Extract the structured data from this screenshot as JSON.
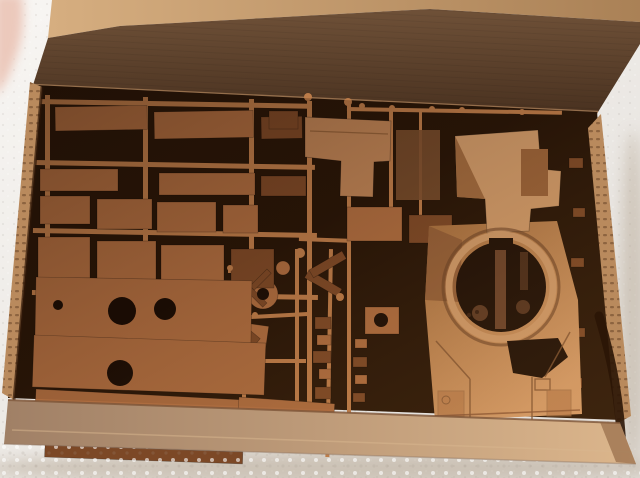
{
  "scene": {
    "image_type": "photograph",
    "subject": "Opened cardboard model-kit box filled with tan plastic sprue frames of tank parts and a one-piece tank upper hull with a circular turret ring, resting on white styrofoam; a fingertip intrudes at the top-left corner",
    "colors": {
      "foam_light": "#f8f6f3",
      "foam_shade": "#e3dfda",
      "finger": "#ecc9bc",
      "lid_edge_light": "#d6ae80",
      "lid_edge_dark": "#aa8156",
      "lid_top": "#6f5138",
      "lid_bottom": "#4a3220",
      "fold_highlight": "#9c7450",
      "interior": "#271507",
      "cardboard": "#b98a5d",
      "cardboard_dark": "#8a5f3c",
      "wall_dark": "#a08066",
      "wall_light": "#dcb68c",
      "sprue": "#ad6c3f",
      "sprue_light": "#cf9257",
      "sprue_dark": "#7c4826",
      "sprue_runner": "#bd7c49",
      "hole_dark": "#190c04",
      "hull_grad_top": "#a9713f",
      "hull_grad_bottom": "#d29a67",
      "hull_light": "#cf9a69",
      "hull_mid": "#b5794a",
      "hull_dark": "#7e5231",
      "shadow_tint": "#b7a996"
    },
    "sprue": {
      "runners_h": [
        [
          37,
          99,
          273,
          5,
          1
        ],
        [
          35,
          160,
          280,
          5,
          1
        ],
        [
          33,
          228,
          284,
          5,
          1
        ],
        [
          32,
          290,
          286,
          5,
          1
        ],
        [
          347,
          107,
          215,
          4,
          1
        ],
        [
          251,
          315,
          59,
          4,
          -3
        ],
        [
          299,
          237,
          49,
          4,
          2
        ],
        [
          249,
          359,
          57,
          4,
          0
        ],
        [
          298,
          429,
          112,
          5,
          2
        ],
        [
          228,
          269,
          26,
          4,
          0
        ]
      ],
      "runners_v": [
        [
          45,
          95,
          207,
          5,
          0
        ],
        [
          143,
          97,
          205,
          5,
          0
        ],
        [
          249,
          99,
          203,
          5,
          0
        ],
        [
          307,
          101,
          333,
          5,
          0
        ],
        [
          347,
          105,
          329,
          4,
          0
        ],
        [
          389,
          109,
          128,
          4,
          0
        ],
        [
          329,
          249,
          208,
          4,
          1
        ],
        [
          295,
          249,
          192,
          4,
          0
        ],
        [
          242,
          275,
          142,
          4,
          0
        ],
        [
          419,
          109,
          124,
          3,
          0
        ]
      ],
      "discs": [
        [
          263,
          294,
          15
        ],
        [
          318,
          130,
          6
        ],
        [
          283,
          268,
          7
        ]
      ],
      "panels": [
        [
          55,
          107,
          92,
          24,
          -1,
          0
        ],
        [
          154,
          112,
          99,
          27,
          -1,
          0
        ],
        [
          261,
          117,
          41,
          22,
          -1,
          2
        ],
        [
          40,
          169,
          78,
          22,
          0,
          0
        ],
        [
          159,
          173,
          96,
          22,
          0,
          0
        ],
        [
          261,
          176,
          45,
          20,
          0,
          2
        ],
        [
          40,
          196,
          50,
          28,
          0,
          0
        ],
        [
          97,
          199,
          55,
          30,
          0,
          0
        ],
        [
          157,
          202,
          59,
          30,
          0,
          0
        ],
        [
          223,
          205,
          35,
          28,
          0,
          0
        ],
        [
          38,
          237,
          52,
          41,
          0,
          0
        ],
        [
          97,
          241,
          59,
          43,
          0,
          0
        ],
        [
          161,
          245,
          63,
          43,
          0,
          0
        ],
        [
          231,
          249,
          43,
          39,
          0,
          2
        ],
        [
          45,
          289,
          88,
          20,
          1,
          0
        ],
        [
          141,
          294,
          63,
          16,
          1,
          0
        ],
        [
          269,
          111,
          29,
          18,
          0,
          2
        ],
        [
          347,
          207,
          55,
          34,
          0,
          0
        ],
        [
          409,
          215,
          43,
          28,
          0,
          2
        ],
        [
          309,
          270,
          38,
          9,
          30,
          2
        ],
        [
          309,
          270,
          38,
          9,
          -30,
          2
        ],
        [
          365,
          307,
          34,
          27,
          0,
          0
        ],
        [
          315,
          317,
          16,
          12,
          0,
          2
        ],
        [
          317,
          335,
          14,
          10,
          0,
          0
        ],
        [
          313,
          351,
          18,
          12,
          0,
          2
        ],
        [
          319,
          369,
          12,
          10,
          0,
          0
        ],
        [
          315,
          387,
          16,
          12,
          0,
          2
        ],
        [
          317,
          403,
          12,
          10,
          0,
          0
        ],
        [
          355,
          339,
          12,
          9,
          0,
          0
        ],
        [
          353,
          357,
          14,
          10,
          0,
          2
        ],
        [
          355,
          375,
          12,
          9,
          0,
          0
        ],
        [
          353,
          393,
          12,
          9,
          0,
          2
        ],
        [
          245,
          323,
          24,
          27,
          8,
          0
        ],
        [
          251,
          331,
          12,
          10,
          40,
          2
        ],
        [
          250,
          286,
          24,
          6,
          45,
          2
        ],
        [
          250,
          286,
          24,
          6,
          -45,
          2
        ],
        [
          36,
          277,
          216,
          62,
          1,
          0
        ],
        [
          34,
          335,
          232,
          52,
          2,
          0
        ],
        [
          36,
          389,
          238,
          40,
          3,
          0
        ],
        [
          239,
          397,
          96,
          36,
          4,
          0
        ],
        [
          45,
          445,
          198,
          12,
          2,
          2
        ],
        [
          569,
          158,
          14,
          10,
          0,
          2
        ],
        [
          573,
          208,
          12,
          9,
          0,
          2
        ],
        [
          571,
          258,
          13,
          9,
          0,
          2
        ],
        [
          573,
          328,
          12,
          9,
          0,
          2
        ],
        [
          569,
          378,
          13,
          10,
          0,
          2
        ]
      ],
      "holes": [
        [
          122,
          311,
          14
        ],
        [
          165,
          309,
          11
        ],
        [
          120,
          373,
          13
        ],
        [
          381,
          320,
          7
        ],
        [
          263,
          294,
          6
        ],
        [
          58,
          305,
          5
        ]
      ],
      "nubs": [
        [
          362,
          106,
          3
        ],
        [
          392,
          108,
          3
        ],
        [
          432,
          109,
          3
        ],
        [
          462,
          110,
          3
        ],
        [
          522,
          112,
          3
        ],
        [
          300,
          253,
          5
        ],
        [
          340,
          297,
          4
        ],
        [
          308,
          97,
          4
        ],
        [
          348,
          102,
          4
        ],
        [
          255,
          315,
          3
        ],
        [
          230,
          268,
          3
        ]
      ]
    }
  }
}
